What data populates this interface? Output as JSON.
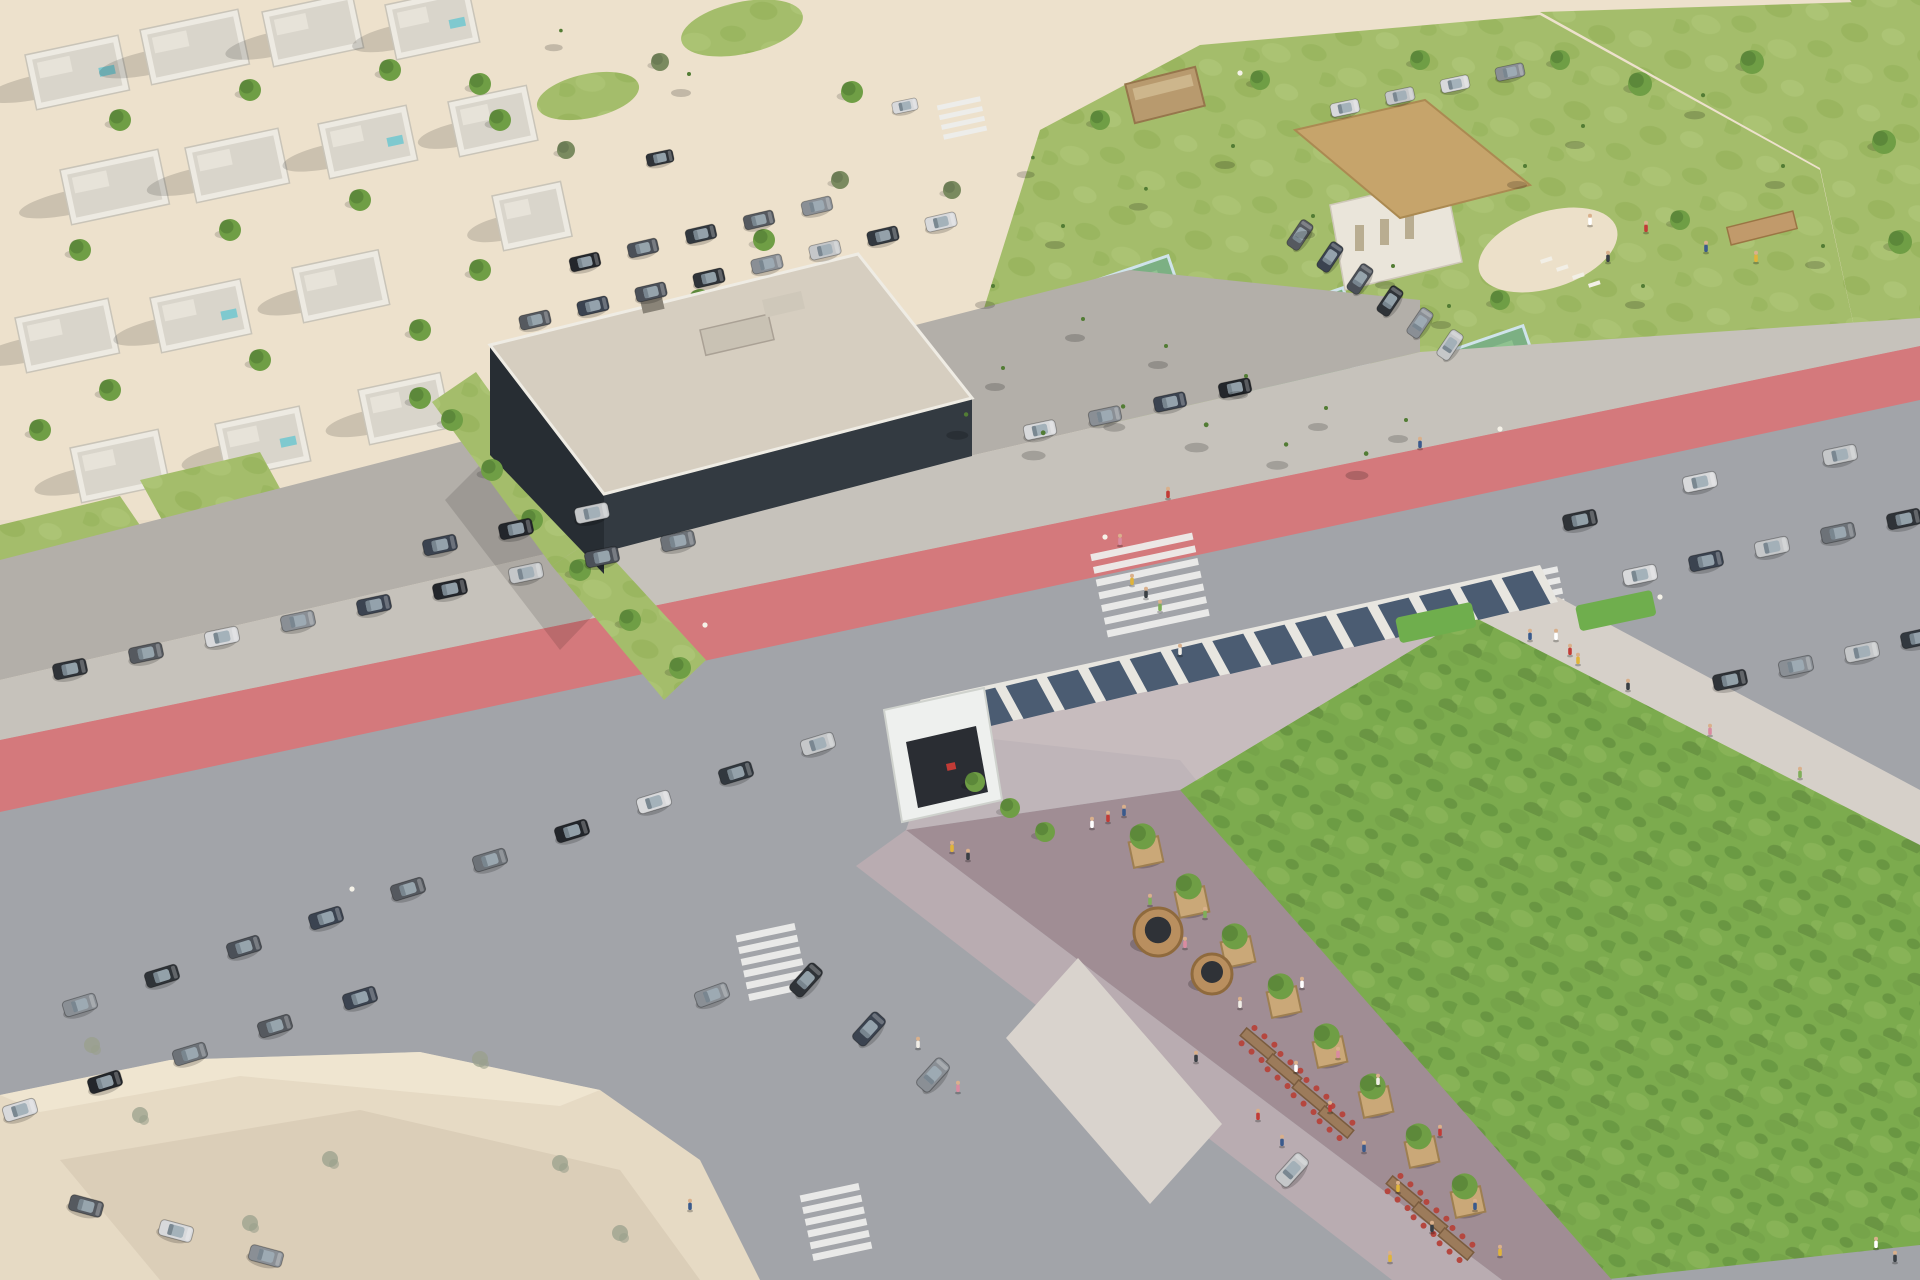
{
  "meta": {
    "title": "Aerial architectural rendering of a coastal mixed-use development with a green-roof commercial building, sports club with lagoon pool and padel courts, roads with red bike lanes, and parking areas",
    "view": "aerial oblique drone view",
    "time_of_day": "sunny daytime"
  },
  "palette": {
    "sand": "#e9dcc7",
    "sandLight": "#f1e7d3",
    "sandShadow": "#d8c9b2",
    "plazaBeige": "#e6dac4",
    "plazaShadow": "#cfc1ab",
    "asphalt": "#a2a4a9",
    "asphaltLight": "#b6b2ab",
    "parkingPave": "#b3afa9",
    "redLane": "#d4797c",
    "redLaneDark": "#c9666a",
    "roadLine": "#ededeb",
    "sidewalk": "#c6c2bb",
    "sidewalkLight": "#d6d0c9",
    "hedgeDark": "#46663a",
    "hedgeMid": "#587c44",
    "hedgeBright": "#6fae4d",
    "lawn": "#a4bd6b",
    "lawnDark": "#8fae53",
    "lawnLight": "#b7cc80",
    "treeGreen": "#6f9e45",
    "treeDark": "#527c34",
    "olive": "#7a8a5f",
    "bareTree": "#9aa08c",
    "palmFrond": "#5c7f3f",
    "palmTrunk": "#8a7a62",
    "poolWater": "#9ed4d8",
    "poolDeep": "#7dc0ca",
    "beachSand": "#ece0c9",
    "thatch": "#c6a46b",
    "thatchDark": "#ab8a52",
    "cabinWood": "#b89a6e",
    "courtGreen": "#7cb083",
    "courtInner": "#8fc290",
    "courtGlass": "#cfe3ea",
    "aptRoof": "#d6cec0",
    "aptFacade": "#333a41",
    "aptFacadeSide": "#272d33",
    "aptBand": "#e7e8e9",
    "deckLight": "#d6d0c9",
    "canopyFrame": "#e8e6e0",
    "canopyPanel": "#3d5068",
    "roofGreen": "#7cab4e",
    "roofGreenDark": "#5e8f3c",
    "roofGreenLight": "#8fb95e",
    "terracePave": "#a08d94",
    "terraceLight": "#c4b8bc",
    "channelDark": "#23262b",
    "parapet": "#ece9e2",
    "facadeStone": "#b9acb1",
    "facadeGlass": "#2a2d33",
    "plankWood": "#caa878",
    "plankEdge": "#9e7f51",
    "kioskWood": "#b98f5f",
    "kioskDark": "#2f3237",
    "tableWood": "#9c7b5b",
    "chairRed": "#b5473f",
    "fenceSlat": "#a19aa8",
    "fenceWhite": "#e8e6e0",
    "carGlass": "#9fadb6",
    "shadow": "#000000",
    "villaWhite": "#edeae2",
    "villaRoof": "#d9d5cb",
    "streetGrey": "#a9a6a0",
    "lampLight": "#f5f2e8"
  },
  "carColors": [
    "#2f3338",
    "#55595f",
    "#d8d9db",
    "#8a8f95",
    "#3b4350",
    "#23262b",
    "#c5c7c9",
    "#4b5058",
    "#6d7278",
    "#32383f"
  ],
  "peopleColors": [
    "#ffffff",
    "#c23b36",
    "#3a5a8c",
    "#e0b43a",
    "#3a3f44",
    "#7fae5a",
    "#d98ba0",
    "#f0ede6"
  ],
  "scene": {
    "zones": [
      {
        "name": "residential-villas",
        "label": "white villa neighbourhood, top left"
      },
      {
        "name": "sand-plaza",
        "label": "sandy esplanade with grass circles and trees, top centre"
      },
      {
        "name": "apartment-building",
        "label": "dark glass apartment block with flat beige roof"
      },
      {
        "name": "sports-club",
        "label": "fenced club with padel courts, thatched pavilion and lagoon pool"
      },
      {
        "name": "lagoon-pool",
        "label": "turquoise lagoon pool with white sand beach and palms"
      },
      {
        "name": "main-road",
        "label": "diagonal avenue with red bike lane, crosswalks and hedges"
      },
      {
        "name": "commercial-building",
        "label": "large retail building with extensive sedum green roof"
      },
      {
        "name": "solar-canopy",
        "label": "photovoltaic pergola along the roof edge"
      },
      {
        "name": "rooftop-terrace",
        "label": "roof promenade with planters, kiosks and restaurant tables"
      },
      {
        "name": "parking-areas",
        "label": "rows of parked cars along service roads and lots"
      },
      {
        "name": "plaza-bottom-left",
        "label": "beige paved plaza with young trees"
      }
    ],
    "approx_counts": {
      "villas": 15,
      "parked_cars": 65,
      "moving_cars": 6,
      "palm_trees": 28,
      "trees": 45,
      "pedestrians": 46,
      "padel_courts": 3,
      "kiosks": 2,
      "planters": 8,
      "dining_tables": 7,
      "crosswalks": 5,
      "cyclists": 2
    }
  }
}
